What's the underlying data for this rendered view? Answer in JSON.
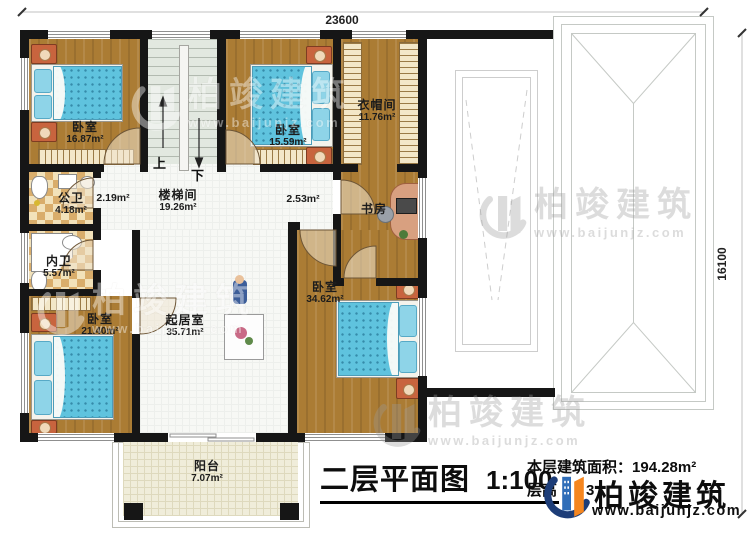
{
  "dimensions": {
    "width_top": "23600",
    "height_right": "16100"
  },
  "stair": {
    "up": "上",
    "down": "下"
  },
  "rooms": {
    "bedroom1": {
      "name": "卧室",
      "area": "16.87m²"
    },
    "stairwell": {
      "name": "楼梯间",
      "area": "19.26m²"
    },
    "bedroom2": {
      "name": "卧室",
      "area": "15.59m²"
    },
    "cloakroom": {
      "name": "衣帽间",
      "area": "11.76m²"
    },
    "public_bath": {
      "name": "公卫",
      "area": "4.18m²"
    },
    "private_bath": {
      "name": "内卫",
      "area": "5.57m²"
    },
    "study": {
      "name": "书房"
    },
    "bedroom3": {
      "name": "卧室",
      "area": "21.40m²"
    },
    "living_room": {
      "name": "起居室",
      "area": "35.71m²"
    },
    "bedroom4": {
      "name": "卧室",
      "area": "34.62m²"
    },
    "balcony": {
      "name": "阳台",
      "area": "7.07m²"
    }
  },
  "hall": {
    "left_area": "2.19m²",
    "right_area": "2.53m²"
  },
  "title": {
    "text": "二层平面图",
    "scale": "1:100"
  },
  "notes": {
    "floor_area_label": "本层建筑面积：",
    "floor_area_value": "194.28m²",
    "floor_height_label": "层高",
    "floor_height_digit": "3"
  },
  "brand": {
    "company": "柏竣建筑",
    "website": "www.baijunjz.com"
  },
  "colors": {
    "wall": "#161616",
    "wood": "#ab7c34",
    "bed_blue": "#5fc3de",
    "logo_blue": "#2f6db8",
    "logo_orange": "#f5861f",
    "logo_navy": "#1d3d78"
  }
}
